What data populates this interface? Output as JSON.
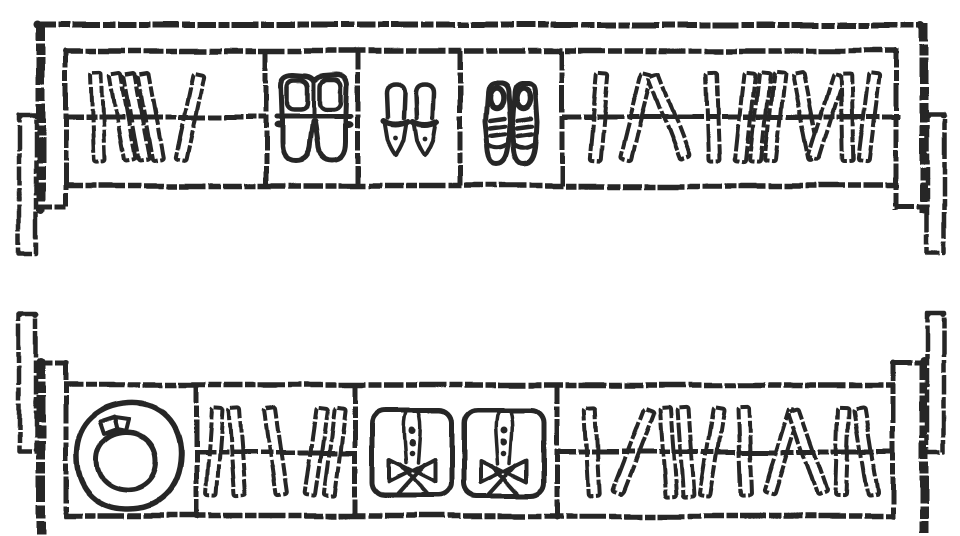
{
  "page": {
    "background": "#ffffff",
    "ink": "#262626"
  },
  "drawing": {
    "width": 960,
    "height": 536,
    "book": {
      "w": 11,
      "h": 88
    },
    "units": [
      {
        "name": "upper-shelf-unit",
        "frame": {
          "lines": [
            {
              "name": "outer-top-edge",
              "x1": 37,
              "y1": 25,
              "x2": 922,
              "y2": 25,
              "w": 6
            },
            {
              "name": "left-leg",
              "x1": 41,
              "y1": 23,
              "x2": 41,
              "y2": 211,
              "w": 9
            },
            {
              "name": "left-support-tick",
              "x1": 34,
              "y1": 207,
              "x2": 66,
              "y2": 207,
              "w": 5
            },
            {
              "name": "right-leg",
              "x1": 924,
              "y1": 23,
              "x2": 924,
              "y2": 213,
              "w": 9
            },
            {
              "name": "right-support-tick",
              "x1": 895,
              "y1": 207,
              "x2": 927,
              "y2": 207,
              "w": 5
            },
            {
              "name": "cabinet-top",
              "x1": 64,
              "y1": 51,
              "x2": 899,
              "y2": 51,
              "w": 5.5
            },
            {
              "name": "cabinet-bottom",
              "x1": 64,
              "y1": 186,
              "x2": 899,
              "y2": 186,
              "w": 5.5
            },
            {
              "name": "cabinet-left",
              "x1": 66,
              "y1": 49,
              "x2": 66,
              "y2": 208,
              "w": 5
            },
            {
              "name": "cabinet-right",
              "x1": 896,
              "y1": 49,
              "x2": 896,
              "y2": 210,
              "w": 5
            },
            {
              "name": "divider-1",
              "x1": 266,
              "y1": 51,
              "x2": 266,
              "y2": 186,
              "w": 5
            },
            {
              "name": "divider-2",
              "x1": 358,
              "y1": 51,
              "x2": 358,
              "y2": 186,
              "w": 5
            },
            {
              "name": "divider-3",
              "x1": 460,
              "y1": 51,
              "x2": 460,
              "y2": 186,
              "w": 5
            },
            {
              "name": "divider-4",
              "x1": 562,
              "y1": 51,
              "x2": 562,
              "y2": 186,
              "w": 5
            }
          ],
          "rects": [
            {
              "name": "left-bracket",
              "x": 19,
              "y": 114,
              "w": 17,
              "h": 139,
              "sw": 4.5
            },
            {
              "name": "right-bracket",
              "x": 927,
              "y": 114,
              "w": 17,
              "h": 139,
              "sw": 4.5
            }
          ],
          "dots": [
            [
              38,
              25,
              4
            ],
            [
              921,
              25,
              4
            ],
            [
              41,
              209,
              4.5
            ],
            [
              924,
              209,
              4.5
            ],
            [
              20,
              115,
              3
            ],
            [
              36,
              115,
              3
            ],
            [
              928,
              115,
              3
            ],
            [
              943,
              115,
              3
            ],
            [
              66,
              51,
              3
            ],
            [
              896,
              51,
              3
            ]
          ]
        },
        "compartments": [
          {
            "name": "compartment-books-1",
            "label": "books",
            "rail_y": 117,
            "rail": [
              64,
              266
            ],
            "books": [
              [
                98,
                -2
              ],
              [
                123,
                -10
              ],
              [
                137,
                -10
              ],
              [
                151,
                -10
              ],
              [
                190,
                12
              ]
            ]
          },
          {
            "name": "compartment-boots",
            "label": "boots",
            "items": [
              {
                "symbol": "boots",
                "name": "boots-pair",
                "x": 276,
                "y": 70
              }
            ]
          },
          {
            "name": "compartment-heels",
            "label": "high heels",
            "items": [
              {
                "symbol": "heel",
                "name": "heel-shoe-left",
                "x": 383,
                "y": 80
              },
              {
                "symbol": "heel",
                "name": "heel-shoe-right",
                "x": 412,
                "y": 80
              }
            ]
          },
          {
            "name": "compartment-sneakers",
            "label": "sneakers",
            "items": [
              {
                "symbol": "sneaker",
                "name": "sneaker-left",
                "x": 484,
                "y": 79
              },
              {
                "symbol": "sneaker",
                "name": "sneaker-right",
                "x": 511,
                "y": 79
              }
            ]
          },
          {
            "name": "compartment-books-2",
            "label": "books",
            "rail_y": 117,
            "rail": [
              562,
              900
            ],
            "books": [
              [
                599,
                5
              ],
              [
                636,
                14
              ],
              [
                669,
                -21
              ],
              [
                713,
                -2
              ],
              [
                745,
                6
              ],
              [
                760,
                6
              ],
              [
                775,
                6
              ],
              [
                806,
                -11
              ],
              [
                826,
                17
              ],
              [
                847,
                -1
              ],
              [
                869,
                7
              ]
            ]
          }
        ]
      },
      {
        "name": "lower-shelf-unit",
        "frame": {
          "lines": [
            {
              "name": "left-leg",
              "x1": 41,
              "y1": 361,
              "x2": 41,
              "y2": 534,
              "w": 9
            },
            {
              "name": "left-support-tick",
              "x1": 34,
              "y1": 363,
              "x2": 66,
              "y2": 363,
              "w": 5
            },
            {
              "name": "right-leg",
              "x1": 924,
              "y1": 361,
              "x2": 924,
              "y2": 533,
              "w": 9
            },
            {
              "name": "right-support-tick",
              "x1": 893,
              "y1": 363,
              "x2": 927,
              "y2": 363,
              "w": 5
            },
            {
              "name": "cabinet-top",
              "x1": 64,
              "y1": 385,
              "x2": 895,
              "y2": 385,
              "w": 5.5
            },
            {
              "name": "cabinet-bottom",
              "x1": 64,
              "y1": 516,
              "x2": 895,
              "y2": 516,
              "w": 5.5
            },
            {
              "name": "cabinet-left",
              "x1": 66,
              "y1": 362,
              "x2": 66,
              "y2": 518,
              "w": 5
            },
            {
              "name": "cabinet-right",
              "x1": 893,
              "y1": 362,
              "x2": 893,
              "y2": 518,
              "w": 5
            },
            {
              "name": "divider-1",
              "x1": 196,
              "y1": 385,
              "x2": 196,
              "y2": 516,
              "w": 5
            },
            {
              "name": "divider-2",
              "x1": 355,
              "y1": 385,
              "x2": 355,
              "y2": 516,
              "w": 5
            },
            {
              "name": "divider-3",
              "x1": 557,
              "y1": 385,
              "x2": 557,
              "y2": 516,
              "w": 5
            }
          ],
          "rects": [
            {
              "name": "left-bracket",
              "x": 19,
              "y": 313,
              "w": 17,
              "h": 139,
              "sw": 4.5
            },
            {
              "name": "right-bracket",
              "x": 927,
              "y": 313,
              "w": 17,
              "h": 140,
              "sw": 4.5
            }
          ],
          "dots": [
            [
              41,
              362,
              4.5
            ],
            [
              924,
              362,
              4.5
            ],
            [
              20,
              314,
              3
            ],
            [
              36,
              314,
              3
            ],
            [
              928,
              314,
              3
            ],
            [
              943,
              314,
              3
            ],
            [
              196,
              516,
              3.5
            ],
            [
              557,
              516,
              3.5
            ],
            [
              66,
              363,
              3
            ],
            [
              893,
              363,
              3
            ]
          ]
        },
        "compartments": [
          {
            "name": "compartment-hat",
            "label": "hat",
            "items": [
              {
                "symbol": "hat",
                "name": "hat",
                "x": 73,
                "y": 400
              }
            ]
          },
          {
            "name": "compartment-books-3",
            "label": "books",
            "rail_y": 452,
            "rail": [
              196,
              355
            ],
            "books": [
              [
                214,
                4
              ],
              [
                237,
                -4
              ],
              [
                276,
                -8
              ],
              [
                316,
                8
              ],
              [
                335,
                7
              ]
            ]
          },
          {
            "name": "compartment-shirts",
            "label": "folded shirts",
            "items": [
              {
                "symbol": "shirt",
                "name": "folded-shirt-left",
                "x": 370,
                "y": 408
              },
              {
                "symbol": "shirt",
                "name": "folded-shirt-right",
                "x": 462,
                "y": 408
              }
            ]
          },
          {
            "name": "compartment-books-4",
            "label": "books",
            "rail_y": 452,
            "rail": [
              557,
              895
            ],
            "books": [
              [
                592,
                -3
              ],
              [
                633,
                21
              ],
              [
                668,
                -4
              ],
              [
                686,
                -4
              ],
              [
                712,
                9
              ],
              [
                745,
                -2
              ],
              [
                782,
                17
              ],
              [
                808,
                -19
              ],
              [
                842,
                2
              ],
              [
                866,
                -9
              ]
            ]
          }
        ]
      }
    ]
  }
}
